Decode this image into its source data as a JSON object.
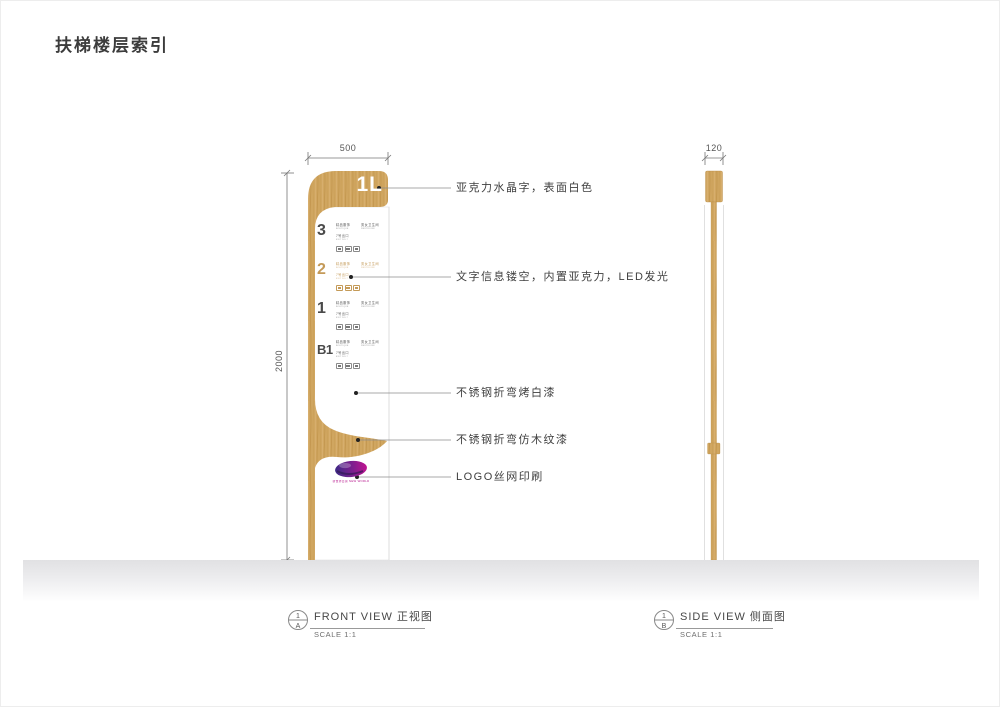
{
  "page": {
    "title": "扶梯楼层索引"
  },
  "front_view": {
    "width_dim": "500",
    "height_dim": "2000",
    "header_label": "1L",
    "amenity_icons": [
      "escalator-icon",
      "elevator-icon",
      "restroom-icon"
    ],
    "floors": [
      {
        "number": "3",
        "store": "精品服饰",
        "store_en": "BOUTIQUE",
        "facility": "男女卫生间",
        "facility_en": "RESTROOM",
        "exit": "7号出口",
        "exit_en": "EXIT NO.7",
        "highlighted": false
      },
      {
        "number": "2",
        "store": "精品服饰",
        "store_en": "BOUTIQUE",
        "facility": "男女卫生间",
        "facility_en": "RESTROOM",
        "exit": "7号出口",
        "exit_en": "EXIT NO.7",
        "highlighted": true
      },
      {
        "number": "1",
        "store": "精品服饰",
        "store_en": "BOUTIQUE",
        "facility": "男女卫生间",
        "facility_en": "RESTROOM",
        "exit": "7号出口",
        "exit_en": "EXIT NO.7",
        "highlighted": false
      },
      {
        "number": "B1",
        "store": "精品服饰",
        "store_en": "BOUTIQUE",
        "facility": "男女卫生间",
        "facility_en": "RESTROOM",
        "exit": "7号出口",
        "exit_en": "EXIT NO.7",
        "highlighted": false
      }
    ],
    "annotations": [
      {
        "text": "亚克力水晶字，表面白色"
      },
      {
        "text": "文字信息镂空，内置亚克力，LED发光"
      },
      {
        "text": "不锈钢折弯烤白漆"
      },
      {
        "text": "不锈钢折弯仿木纹漆"
      },
      {
        "text": "LOGO丝网印刷"
      }
    ],
    "logo_text": "新世界百货 NEW WORLD",
    "caption": {
      "ref_top": "1",
      "ref_bottom": "A",
      "label": "FRONT VIEW 正视图",
      "scale": "SCALE 1:1"
    }
  },
  "side_view": {
    "width_dim": "120",
    "caption": {
      "ref_top": "1",
      "ref_bottom": "B",
      "label": "SIDE VIEW 侧面图",
      "scale": "SCALE 1:1"
    }
  },
  "colors": {
    "wood": "#d0a660",
    "wood_grain": "#bd9047",
    "highlight": "#c49a58",
    "ink": "#3f3f3f",
    "logo_purple": "#3f2a86",
    "logo_magenta": "#c01390"
  }
}
